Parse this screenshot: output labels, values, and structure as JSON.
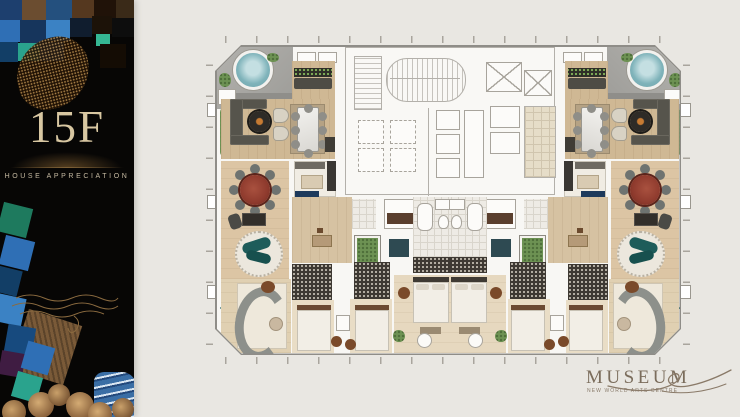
{
  "slide": {
    "sidebar": {
      "floor_label": "15F",
      "subtitle": "HOUSE APPRECIATION"
    },
    "brand": {
      "wordmark": "MUSEUM",
      "tagline": "NEW WORLD ARTS CENTRE"
    },
    "palette": {
      "page_bg": "#e9e7e2",
      "sidebar_bg": "#070605",
      "gold_text": "#d8c7a2",
      "subtitle_text": "#c6baa2",
      "logo_text": "#7b6d5c",
      "plan_bg": "#f8f7f4",
      "plan_outline": "#8f8d88",
      "wood_floor": "#cfb894",
      "terrace_gray": "#a8a7a3",
      "jacuzzi_blue": "#7fb3ba",
      "plant_green": "#6d9253",
      "red_table": "#8e3a2d",
      "teal_sofa": "#1e5c5a",
      "dark_sofa": "#56544c",
      "marble_table": "#ebe9e4",
      "mosaic_blue": "#2f6fb5",
      "mosaic_teal": "#2aa38d",
      "mosaic_navy": "#123e66",
      "mosaic_brown": "#7a5a38"
    }
  }
}
